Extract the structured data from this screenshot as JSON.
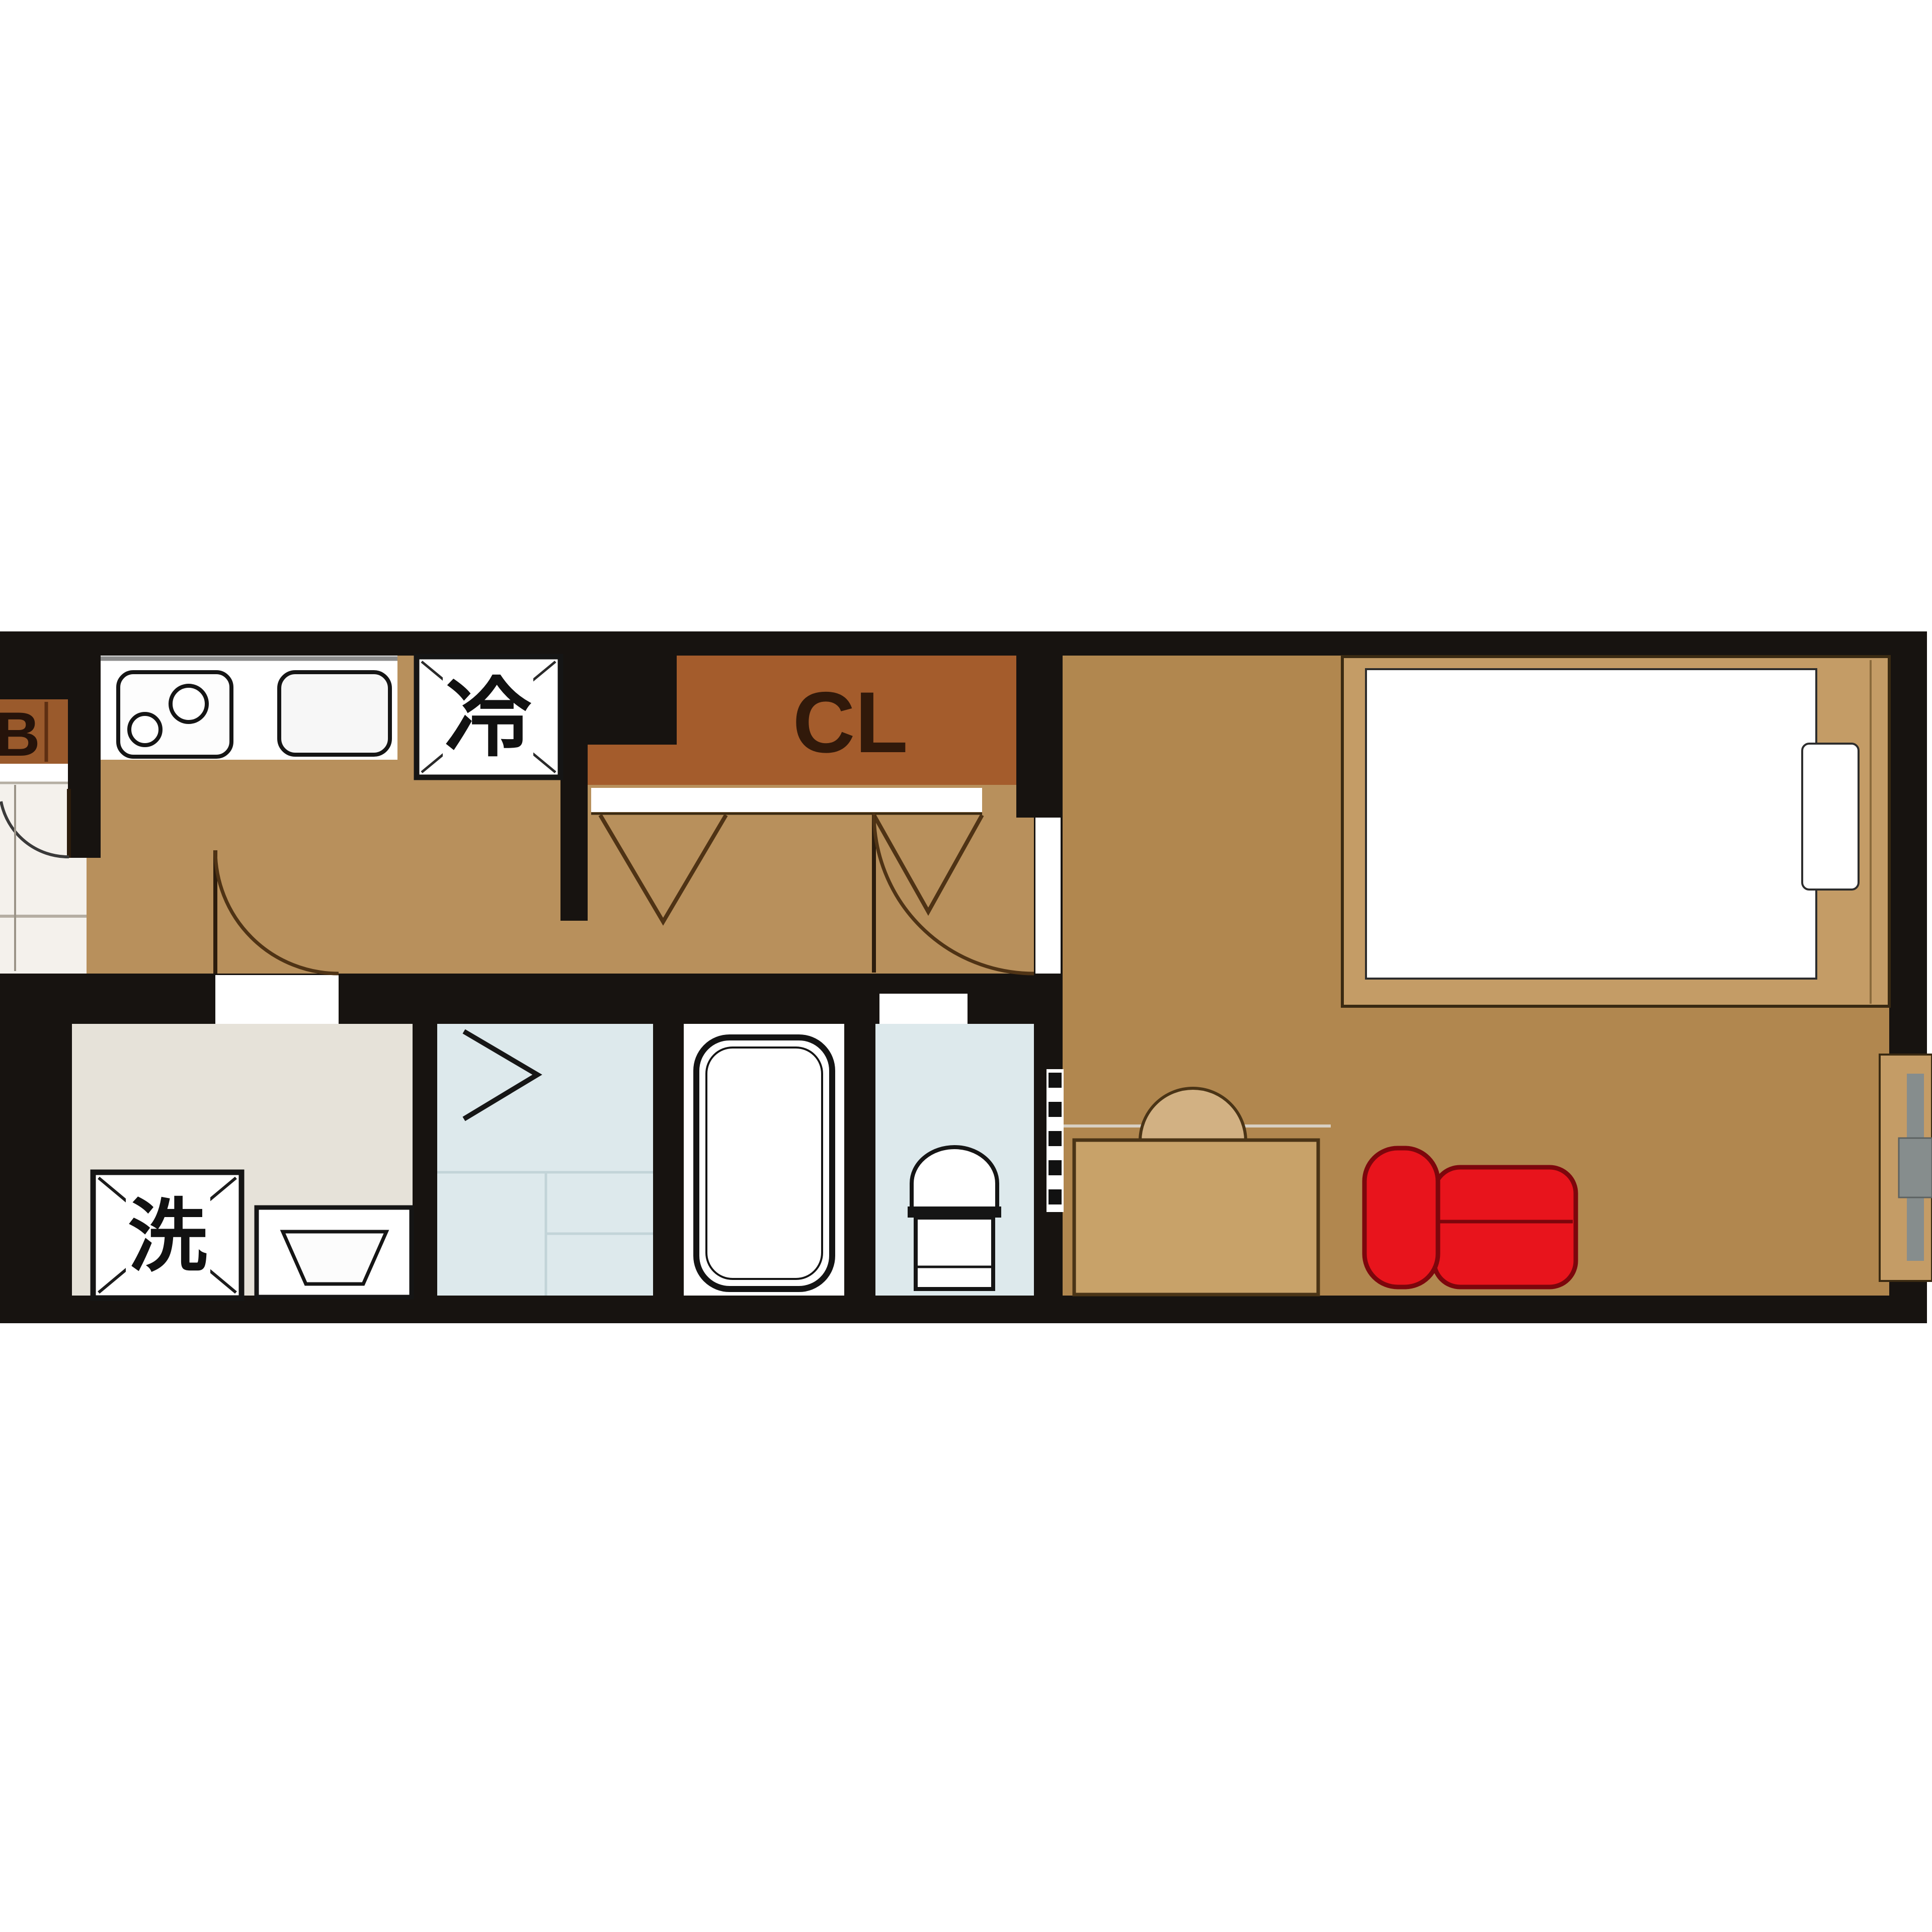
{
  "diagram": {
    "type": "apartment-floor-plan",
    "labels": {
      "closet": "CL",
      "refrigerator": "冷",
      "washer": "洗",
      "balcony": "B"
    },
    "colors": {
      "wall": "#171310",
      "hallway_floor": "#b8905c",
      "room_floor": "#b1874f",
      "closet_fill": "#a45c2c",
      "balcony_fill": "#9a5a2c",
      "wet_room_floor": "#dde9ec",
      "washroom_floor": "#e6e2d9",
      "entrance_floor": "#f4f1ec",
      "bath_floor": "#ffffff",
      "furniture_wood": "#c49c66",
      "desk_wood": "#c8a269",
      "chair_wood": "#d2b183",
      "sofa_red": "#e8141c",
      "sofa_outline": "#7d060c",
      "window_glass": "#868d8d",
      "page_background": "#ffffff"
    },
    "fixtures": [
      "kitchen-stove",
      "kitchen-sink",
      "refrigerator",
      "closet",
      "entrance-door",
      "washroom-door",
      "room-door",
      "folding-closet-doors",
      "folding-bath-door",
      "washing-machine",
      "washbasin",
      "bathtub",
      "toilet",
      "bed",
      "mattress",
      "pillow",
      "desk",
      "chair",
      "sofa",
      "wall-window",
      "wall-hatch"
    ]
  }
}
